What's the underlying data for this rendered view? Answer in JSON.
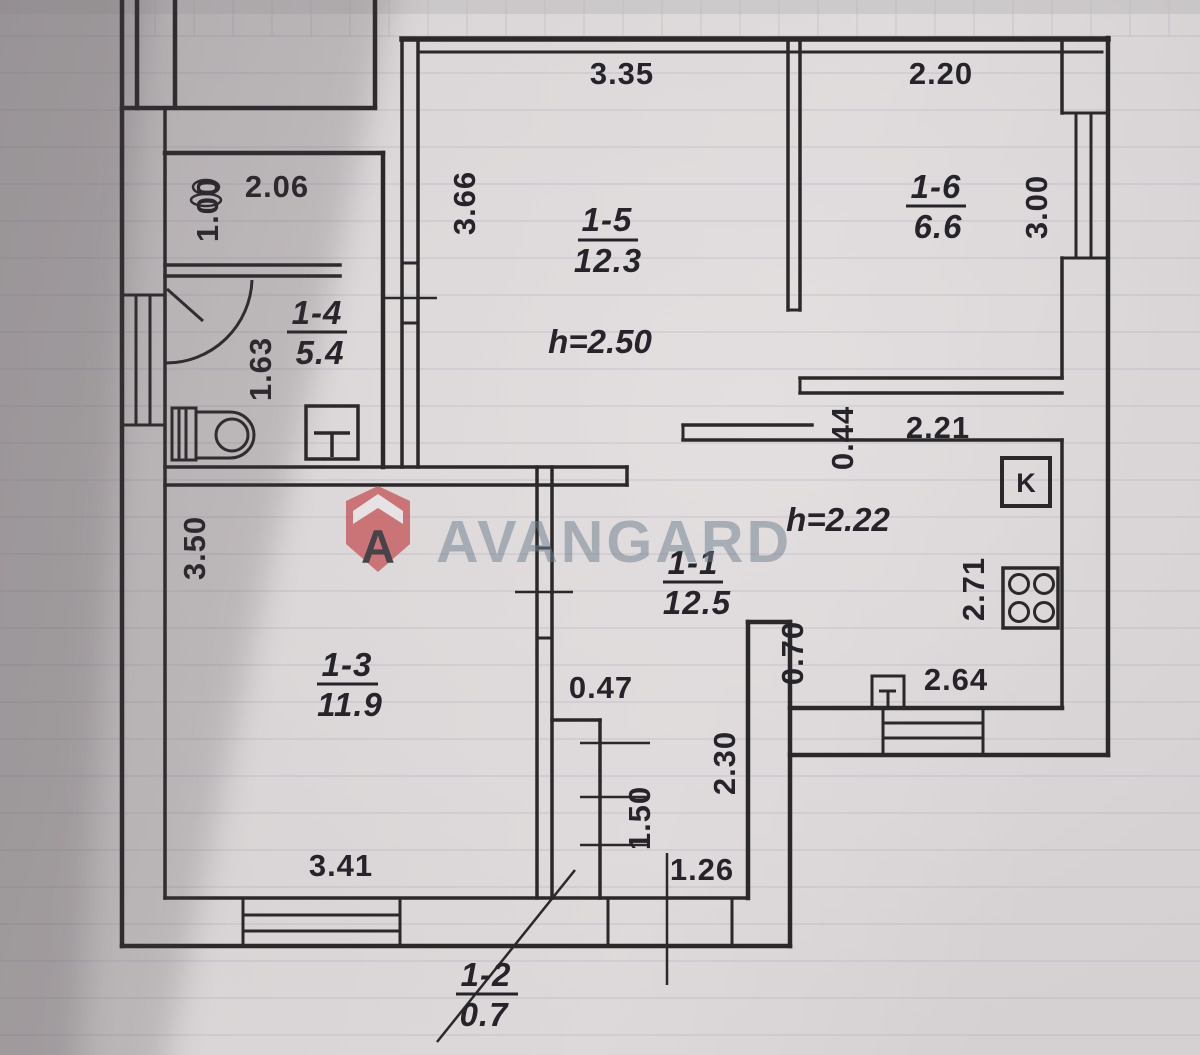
{
  "watermark": {
    "brand": "AVANGARD",
    "logo_letter": "A",
    "text_color": "#6e7e8c",
    "logo_color": "#c75f63"
  },
  "rooms": {
    "r11": {
      "id": "1-1",
      "area": "12.5"
    },
    "r12": {
      "id": "1-2",
      "area": "0.7"
    },
    "r13": {
      "id": "1-3",
      "area": "11.9"
    },
    "r14": {
      "id": "1-4",
      "area": "5.4"
    },
    "r15": {
      "id": "1-5",
      "area": "12.3"
    },
    "r16": {
      "id": "1-6",
      "area": "6.6"
    }
  },
  "ceiling_heights": {
    "living": "h=2.50",
    "kitchen": "h=2.22"
  },
  "dims": {
    "top_left_room_width": "3.35",
    "top_right_room_width": "2.20",
    "bath_width": "2.06",
    "bath_upper_height": "1.00",
    "bath_wc_height": "1.63",
    "room15_height": "3.66",
    "room16_height": "3.00",
    "wall_step": "0.44",
    "kitchen_top_width": "2.21",
    "kitchen_height": "2.71",
    "kitchen_bottom_width": "2.64",
    "kitchen_opening": "0.70",
    "room13_height": "3.50",
    "room13_width": "3.41",
    "hall_jog": "0.47",
    "hall_depth": "2.30",
    "vestibule_height": "1.50",
    "vestibule_width": "1.26"
  },
  "symbols": {
    "kitchen_box": "K"
  }
}
